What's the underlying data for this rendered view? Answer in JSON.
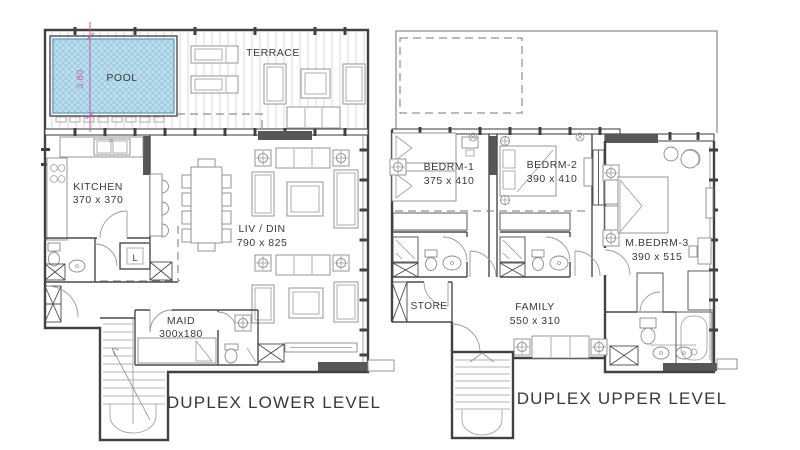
{
  "meta": {
    "drawing_type": "residential duplex apartment floor plans",
    "levels": 2
  },
  "colors": {
    "pool_fill": "#bcdeee",
    "pool_hatch": "#93c6da",
    "dimension_magenta": "#bf5ba8",
    "wall": "#414141",
    "dark_fill": "#575757",
    "background": "#ffffff"
  },
  "lower_plan": {
    "title": "DUPLEX LOWER LEVEL",
    "rooms": {
      "pool": "POOL",
      "pool_width_dim": "3.80",
      "terrace": "TERRACE",
      "kitchen": "KITCHEN",
      "kitchen_dim": "370 x 370",
      "living_dining": "LIV / DIN",
      "living_dining_dim": "790 x 825",
      "maid": "MAID",
      "maid_dim": "300x180",
      "laundry": "L"
    }
  },
  "upper_plan": {
    "title": "DUPLEX UPPER LEVEL",
    "rooms": {
      "bedroom1": "BEDRM-1",
      "bedroom1_dim": "375 x 410",
      "bedroom2": "BEDRM-2",
      "bedroom2_dim": "390 x 410",
      "master_bedroom": "M.BEDRM-3",
      "master_bedroom_dim": "390 x 515",
      "store": "STORE",
      "family": "FAMILY",
      "family_dim": "550 x 310"
    }
  }
}
